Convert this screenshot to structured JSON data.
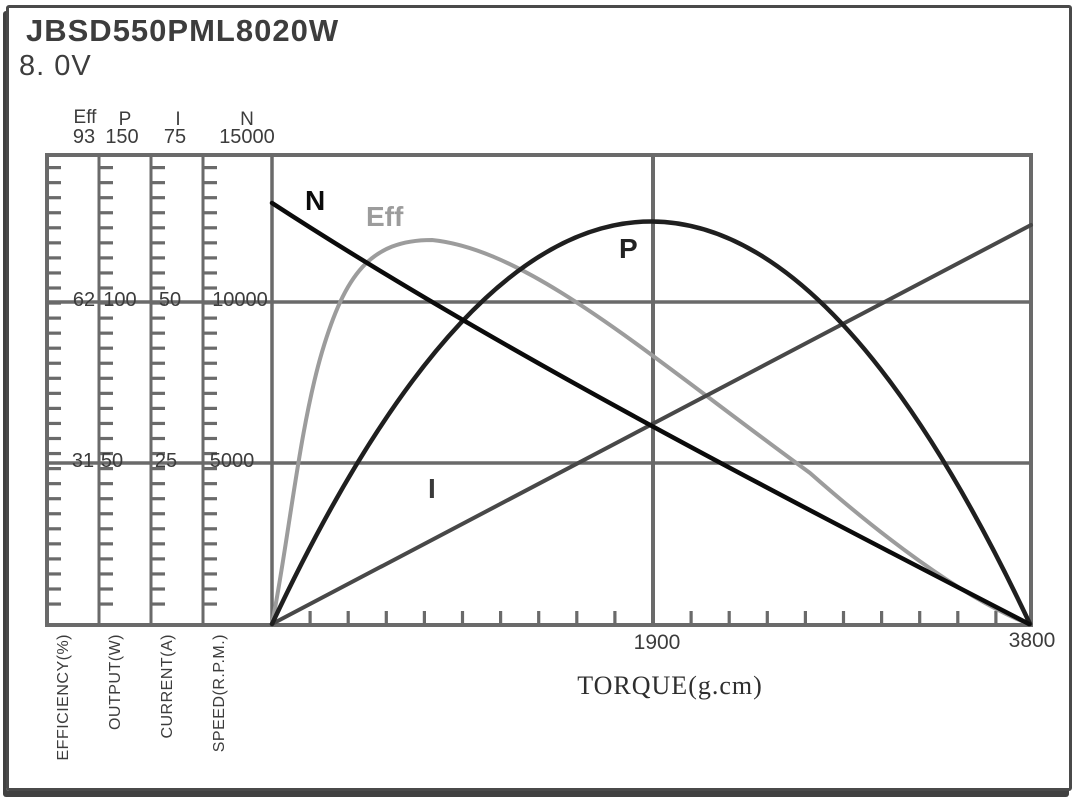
{
  "header": {
    "model": "JBSD550PML8020W",
    "voltage": "8. 0V"
  },
  "y_axes": [
    {
      "id": "eff",
      "name": "Eff",
      "ticks": [
        "93",
        "62",
        "31"
      ],
      "title": "EFFICIENCY(%)"
    },
    {
      "id": "p",
      "name": "P",
      "ticks": [
        "150",
        "100",
        "50"
      ],
      "title": "OUTPUT(W)"
    },
    {
      "id": "i",
      "name": "I",
      "ticks": [
        "75",
        "50",
        "25"
      ],
      "title": "CURRENT(A)"
    },
    {
      "id": "n",
      "name": "N",
      "ticks": [
        "15000",
        "10000",
        "5000"
      ],
      "title": "SPEED(R.P.M.)"
    }
  ],
  "x_axis": {
    "title": "TORQUE(g.cm)",
    "tick_mid": "1900",
    "tick_end": "3800"
  },
  "curve_labels": {
    "n": "N",
    "eff": "Eff",
    "p": "P",
    "i": "I"
  },
  "colors": {
    "grid": "#6a6a6a",
    "n_curve": "#0b0b0b",
    "eff_curve": "#9c9c9c",
    "p_curve": "#1f1f1f",
    "i_curve": "#484848",
    "text": "#3c3c3c"
  },
  "chart_data": {
    "type": "line",
    "title": "JBSD550PML8020W motor performance curves at 8.0V",
    "x": {
      "label": "TORQUE(g.cm)",
      "min": 0,
      "max": 3800,
      "ticks": [
        1900,
        3800
      ],
      "minor_tick_step": 190
    },
    "y_axes": [
      {
        "label": "EFFICIENCY(%)",
        "min": 0,
        "max": 93,
        "ticks": [
          31,
          62,
          93
        ]
      },
      {
        "label": "OUTPUT(W)",
        "min": 0,
        "max": 150,
        "ticks": [
          50,
          100,
          150
        ]
      },
      {
        "label": "CURRENT(A)",
        "min": 0,
        "max": 75,
        "ticks": [
          25,
          50,
          75
        ]
      },
      {
        "label": "SPEED(R.P.M.)",
        "min": 0,
        "max": 15000,
        "ticks": [
          5000,
          10000,
          15000
        ]
      }
    ],
    "grid": true,
    "legend_position": "inline-curve-labels",
    "torque": [
      0,
      380,
      760,
      1140,
      1520,
      1900,
      2280,
      2660,
      3040,
      3420,
      3800
    ],
    "series": [
      {
        "name": "N",
        "axis": "SPEED(R.P.M.)",
        "values": [
          13500,
          12050,
          10650,
          9280,
          7900,
          6550,
          5200,
          3870,
          2570,
          1280,
          0
        ]
      },
      {
        "name": "Eff",
        "axis": "EFFICIENCY(%)",
        "values": [
          0,
          57,
          76,
          74,
          64,
          52,
          41,
          30,
          21,
          10,
          0
        ]
      },
      {
        "name": "P",
        "axis": "OUTPUT(W)",
        "values": [
          0,
          46,
          82,
          108,
          123,
          129,
          123,
          108,
          82,
          46,
          0
        ]
      },
      {
        "name": "I",
        "axis": "CURRENT(A)",
        "values": [
          0,
          6.4,
          12.8,
          19.1,
          25.5,
          31.9,
          38.3,
          44.7,
          51.0,
          57.4,
          63.8
        ]
      }
    ]
  }
}
